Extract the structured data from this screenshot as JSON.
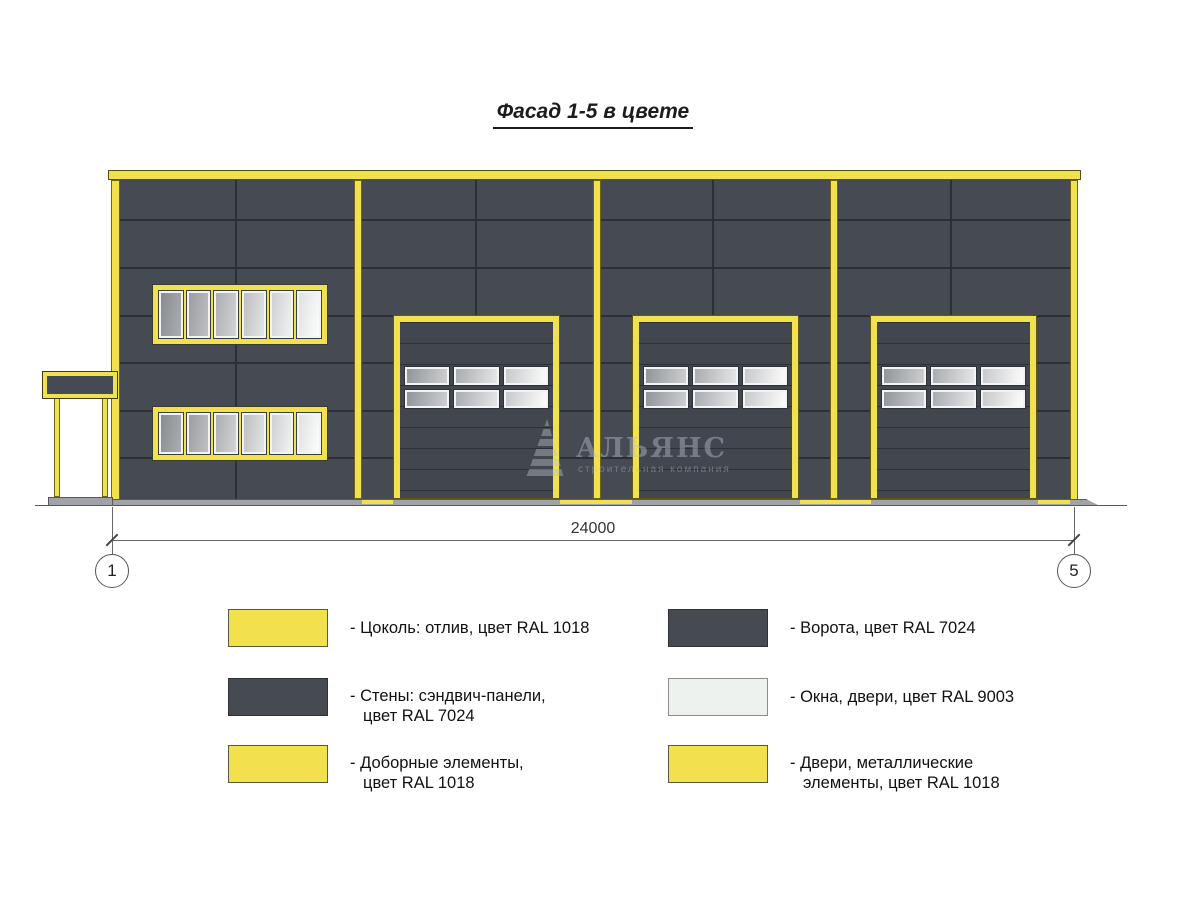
{
  "title": "Фасад 1-5 в цвете",
  "facade": {
    "dimension_label": "24000",
    "axis_left": "1",
    "axis_right": "5"
  },
  "watermark": {
    "logo": "pyramid-logo",
    "name": "АЛЬЯНС",
    "tagline": "строительная компания"
  },
  "colors": {
    "yellow_ral1018": "#F2E14C",
    "dark_ral7024": "#464B52",
    "white_ral9003": "#EDF2EE",
    "ground_gray": "#A0A4A8"
  },
  "legend": {
    "items": [
      {
        "color_key": "yellow_ral1018",
        "lines": [
          "- Цоколь: отлив, цвет RAL 1018",
          ""
        ]
      },
      {
        "color_key": "dark_ral7024",
        "lines": [
          "- Стены: сэндвич-панели,",
          "цвет RAL 7024"
        ]
      },
      {
        "color_key": "yellow_ral1018",
        "lines": [
          "- Доборные элементы,",
          "цвет RAL 1018"
        ]
      },
      {
        "color_key": "dark_ral7024",
        "lines": [
          "- Ворота, цвет RAL 7024",
          ""
        ]
      },
      {
        "color_key": "white_ral9003",
        "lines": [
          "- Окна, двери, цвет RAL 9003",
          ""
        ]
      },
      {
        "color_key": "yellow_ral1018",
        "lines": [
          "- Двери, металлические",
          "элементы, цвет RAL 1018"
        ]
      }
    ]
  }
}
